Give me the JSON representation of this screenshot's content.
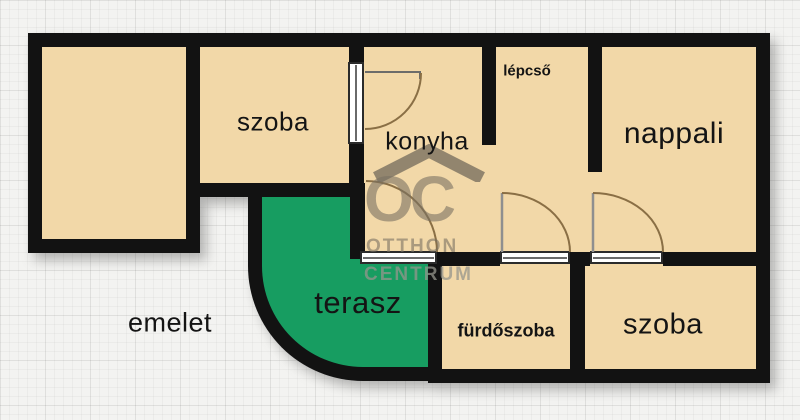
{
  "plan": {
    "floor_label": "emelet",
    "rooms": {
      "szoba_top": "szoba",
      "konyha": "konyha",
      "lepcso": "lépcső",
      "nappali": "nappali",
      "terasz": "terasz",
      "furdoszoba": "fürdőszoba",
      "szoba_bottom": "szoba"
    }
  },
  "watermark": {
    "logo": "OC",
    "line1": "OTTHON",
    "line2": "CENTRUM"
  },
  "colors": {
    "room_fill": "#f2d8a8",
    "terrace_fill": "#179d61",
    "wall": "#121212",
    "paper_background": "#f3f3f1",
    "watermark_grey": "#7a7262",
    "door_arc": "#8a6f45",
    "door_leaf": "#8f8f8f"
  }
}
